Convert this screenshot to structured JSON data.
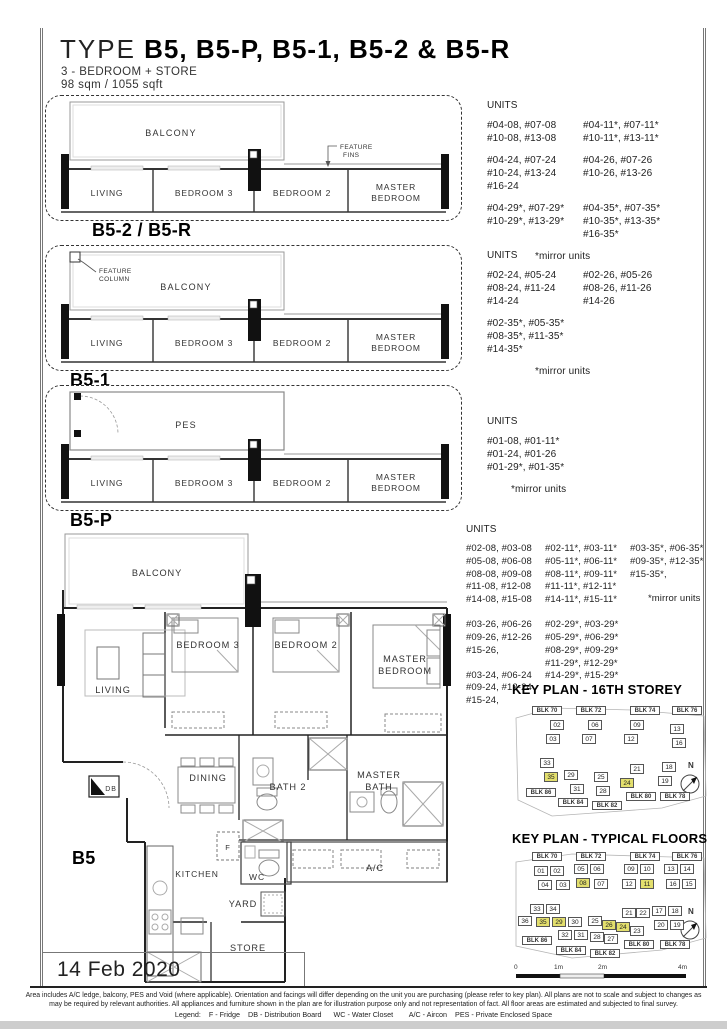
{
  "page": {
    "title_prefix": "TYPE",
    "title": "B5, B5-P, B5-1, B5-2 & B5-R",
    "subtitle_line1": "3 - BEDROOM + STORE",
    "subtitle_line2": "98 sqm / 1055 sqft",
    "date": "14 Feb 2020",
    "footer_line1": "Area includes A/C ledge, balcony, PES and Void (where applicable). Orientation and facings will differ depending on the unit you are purchasing (please refer to key plan). All plans are not to scale and subject to changes as",
    "footer_line2": "may be required by relevant authorities. All appliances and furniture shown in the plan are for illustration purpose only and not representation of fact. All floor areas are estimated and subjected to final survey.",
    "footer_legend": "Legend:    F - Fridge    DB - Distribution Board      WC - Water Closet        A/C - Aircon    PES - Private Enclosed Space"
  },
  "colors": {
    "highlight_yellow": "#e3df6d",
    "wall_black": "#111111",
    "line_gray": "#888888"
  },
  "variants": [
    {
      "label": "B5-2 / B5-R",
      "outdoor": "BALCONY",
      "annotation_l1": "FEATURE",
      "annotation_l2": "FINS",
      "rooms": {
        "living": "LIVING",
        "bed3": "BEDROOM 3",
        "bed2": "BEDROOM 2",
        "master_l1": "MASTER",
        "master_l2": "BEDROOM"
      },
      "units_title": "UNITS",
      "unit_groups": [
        {
          "c1": [
            "#04-08, #07-08",
            "#10-08, #13-08"
          ],
          "c2": [
            "#04-11*, #07-11*",
            "#10-11*, #13-11*"
          ]
        },
        {
          "c1": [
            "#04-24, #07-24",
            "#10-24, #13-24",
            "#16-24"
          ],
          "c2": [
            "#04-26, #07-26",
            "#10-26, #13-26"
          ]
        },
        {
          "c1": [
            "#04-29*, #07-29*",
            "#10-29*, #13-29*"
          ],
          "c2": [
            "#04-35*, #07-35*",
            "#10-35*, #13-35*",
            "#16-35*"
          ]
        }
      ],
      "mirror_note": "*mirror units"
    },
    {
      "label": "B5-1",
      "outdoor": "BALCONY",
      "annotation_l1": "FEATURE",
      "annotation_l2": "COLUMN",
      "rooms": {
        "living": "LIVING",
        "bed3": "BEDROOM 3",
        "bed2": "BEDROOM 2",
        "master_l1": "MASTER",
        "master_l2": "BEDROOM"
      },
      "units_title": "UNITS",
      "unit_groups": [
        {
          "c1": [
            "#02-24, #05-24",
            "#08-24, #11-24",
            "#14-24"
          ],
          "c2": [
            "#02-26, #05-26",
            "#08-26, #11-26",
            "#14-26"
          ]
        },
        {
          "c1": [
            "#02-35*, #05-35*",
            "#08-35*, #11-35*",
            "#14-35*"
          ],
          "c2": []
        }
      ],
      "mirror_note": "*mirror units"
    },
    {
      "label": "B5-P",
      "outdoor": "PES",
      "annotation_l1": "",
      "annotation_l2": "",
      "rooms": {
        "living": "LIVING",
        "bed3": "BEDROOM 3",
        "bed2": "BEDROOM 2",
        "master_l1": "MASTER",
        "master_l2": "BEDROOM"
      },
      "units_title": "UNITS",
      "unit_groups": [
        {
          "c1": [
            "#01-08, #01-11*",
            "#01-24, #01-26",
            "#01-29*, #01-35*"
          ],
          "c2": []
        }
      ],
      "mirror_note": "*mirror units"
    }
  ],
  "b5": {
    "label": "B5",
    "units_title": "UNITS",
    "col1": [
      [
        "#02-08, #03-08",
        "#05-08, #06-08",
        "#08-08, #09-08",
        "#11-08, #12-08",
        "#14-08, #15-08"
      ],
      [
        "#03-26, #06-26",
        "#09-26, #12-26",
        "#15-26,"
      ],
      [
        "#03-24, #06-24",
        "#09-24, #12-24",
        "#15-24,"
      ]
    ],
    "col2": [
      [
        "#02-11*, #03-11*",
        "#05-11*, #06-11*",
        "#08-11*, #09-11*",
        "#11-11*, #12-11*",
        "#14-11*, #15-11*"
      ],
      [
        "#02-29*, #03-29*",
        "#05-29*, #06-29*",
        "#08-29*, #09-29*",
        "#11-29*, #12-29*",
        "#14-29*, #15-29*"
      ]
    ],
    "col3": [
      [
        "#03-35*, #06-35*",
        "#09-35*, #12-35*",
        "#15-35*,"
      ]
    ],
    "mirror_note": "*mirror units",
    "rooms": {
      "balcony": "BALCONY",
      "living": "LIVING",
      "bed3": "BEDROOM 3",
      "bed2": "BEDROOM 2",
      "master_l1": "MASTER",
      "master_l2": "BEDROOM",
      "dining": "DINING",
      "bath2": "BATH 2",
      "mbath_l1": "MASTER",
      "mbath_l2": "BATH",
      "ac": "A/C",
      "fridge": "F",
      "wc": "WC",
      "kitchen": "KITCHEN",
      "yard": "YARD",
      "store": "STORE",
      "db": "DB"
    }
  },
  "key_plan_16": {
    "title": "KEY PLAN - 16TH STOREY",
    "north": "N",
    "blocks": [
      "BLK 70",
      "BLK 72",
      "BLK 74",
      "BLK 76",
      "BLK 86",
      "BLK 84",
      "BLK 82",
      "BLK 80",
      "BLK 78"
    ],
    "units": [
      "02",
      "03",
      "06",
      "07",
      "09",
      "12",
      "13",
      "16",
      "33",
      "35",
      "29",
      "31",
      "25",
      "28",
      "21",
      "24",
      "18",
      "19"
    ],
    "highlighted_units": [
      "35",
      "24"
    ]
  },
  "key_plan_typ": {
    "title": "KEY PLAN - TYPICAL FLOORS",
    "north": "N",
    "blocks": [
      "BLK 70",
      "BLK 72",
      "BLK 74",
      "BLK 76",
      "BLK 86",
      "BLK 84",
      "BLK 82",
      "BLK 80",
      "BLK 78"
    ],
    "units": [
      "01",
      "02",
      "04",
      "03",
      "05",
      "06",
      "08",
      "07",
      "09",
      "10",
      "12",
      "11",
      "13",
      "14",
      "16",
      "15",
      "33",
      "34",
      "36",
      "35",
      "29",
      "30",
      "32",
      "31",
      "25",
      "26",
      "24",
      "23",
      "28",
      "27",
      "21",
      "22",
      "17",
      "18",
      "20",
      "19"
    ],
    "highlighted_units": [
      "08",
      "11",
      "35",
      "29",
      "26",
      "24"
    ],
    "scale_labels": [
      "0",
      "1m",
      "2m",
      "4m"
    ]
  }
}
